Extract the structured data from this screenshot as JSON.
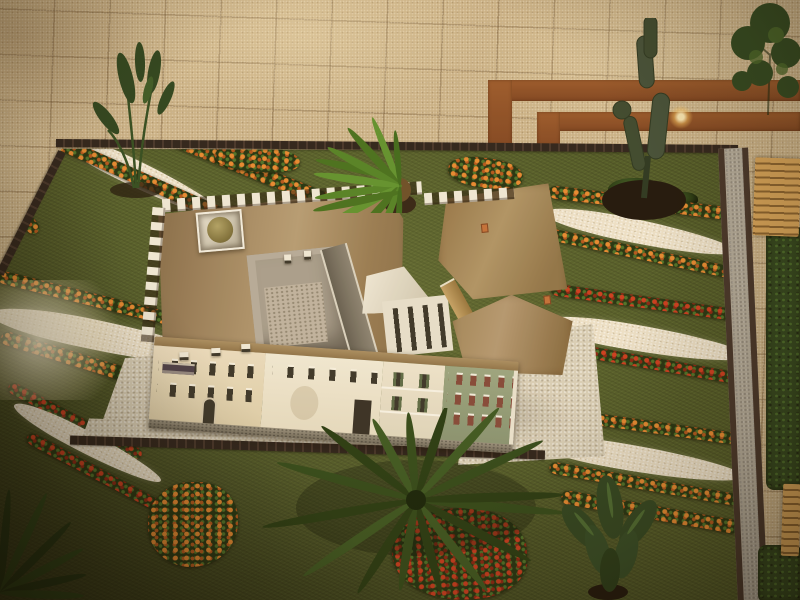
{
  "scene": {
    "type": "photograph",
    "subject": "aerial view of a miniature architectural scale model: a castle-like palace with tan roofs, corner dome tower, crenellated walls and painted house facades, surrounded by formal parterre gardens with diagonal white-gravel bands, orange and red flower rows, palms and exotic plants, set on a beige paved plaza with red-brown inlay bands, a side gravel path, hedge and wooden benches",
    "lighting": "warm indoor evening light, dark vignette toward bottom-left, bright glow on left gravel band",
    "visible_text": ""
  },
  "palette": {
    "pavement": "#c9b28a",
    "accent_band": "#9a5a2e",
    "band_dark": "#7e4422",
    "grass": "#4f5a29",
    "gravel_white": "#ece2cc",
    "brick_edge": "#44342c",
    "flower_orange": "#e68a33",
    "flower_red": "#cc3b20",
    "foliage": "#2c4119",
    "foliage_bright": "#578a2b",
    "roof_tan": "#a78d66",
    "roof_slate": "#6f695c",
    "wall_white": "#efe9da",
    "wall_cream": "#e5d7b8",
    "wall_green": "#97a37f",
    "window_dark": "#39352b",
    "window_brick": "#83483a",
    "shutter_green": "#5c6b48",
    "dome_olive": "#8d8050",
    "stone_base": "#8e8777",
    "cobble": "#d9d0bb",
    "path_gravel": "#b4ada0",
    "bench_wood": "#d8a65c",
    "bench_wood_dark": "#8a6330",
    "hedge": "#2e451f",
    "soil_dark": "#201810"
  }
}
